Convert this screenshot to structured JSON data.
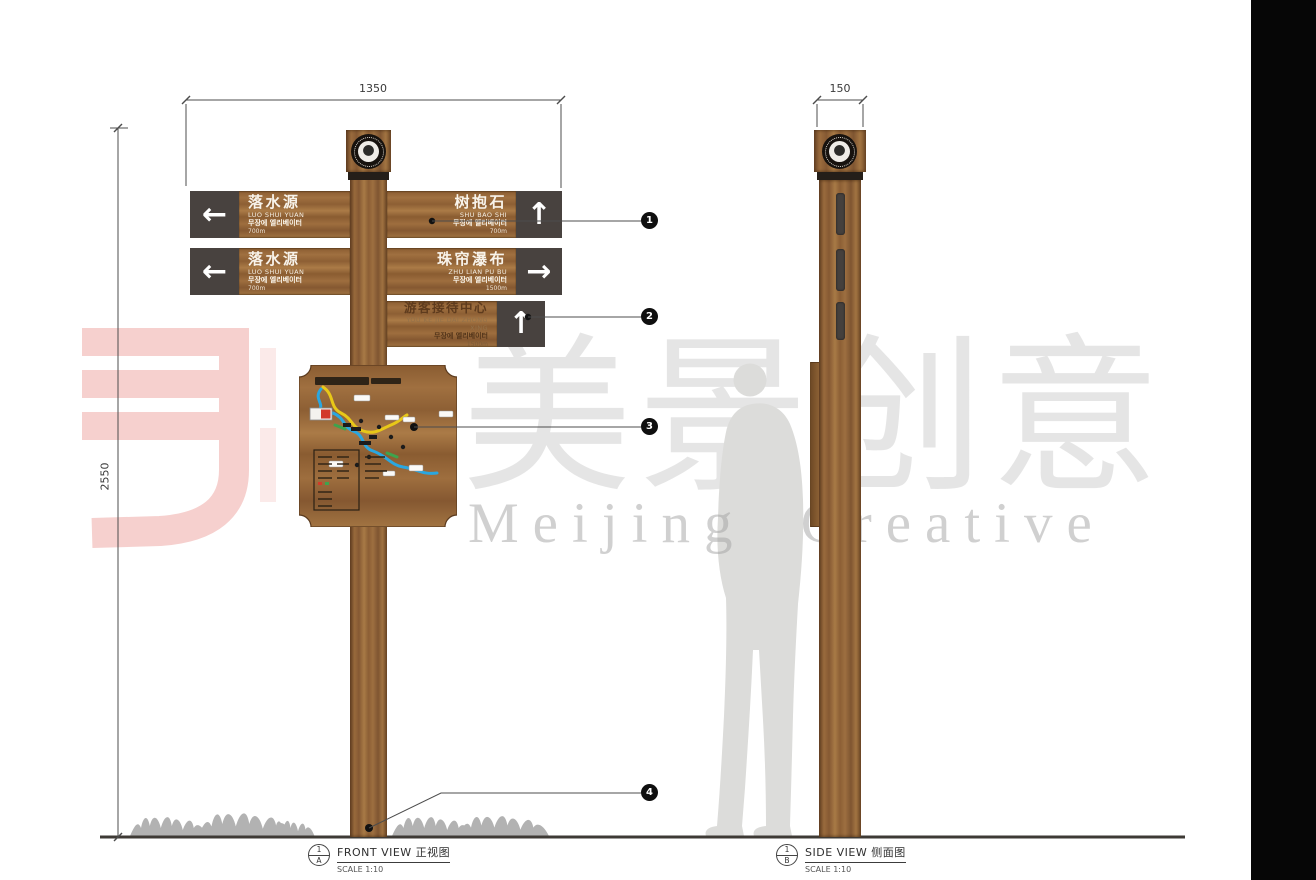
{
  "watermark": {
    "brand_cn": "美景创意",
    "brand_en": "Meijing Creative"
  },
  "dimensions": {
    "front_width": "1350",
    "side_width": "150",
    "height": "2550"
  },
  "callouts": {
    "c1": "1",
    "c2": "2",
    "c3": "3",
    "c4": "4"
  },
  "views": {
    "front": {
      "num": "1",
      "ref": "A",
      "title": "FRONT VIEW 正视图",
      "scale": "SCALE 1:10"
    },
    "side": {
      "num": "1",
      "ref": "B",
      "title": "SIDE VIEW 侧面图",
      "scale": "SCALE 1:10"
    }
  },
  "signs": {
    "row1_left": {
      "title": "落水源",
      "subtitle": "LUO SHUI YUAN",
      "korean": "무장에 엘리베이터",
      "distance": "700m",
      "arrow": "←"
    },
    "row1_right": {
      "title": "树抱石",
      "subtitle": "SHU BAO SHI",
      "korean": "무장에 엘리베이터",
      "distance": "700m",
      "arrow": "↑"
    },
    "row2_left": {
      "title": "落水源",
      "subtitle": "LUO SHUI YUAN",
      "korean": "무장에 엘리베이터",
      "distance": "700m",
      "arrow": "←"
    },
    "row2_right": {
      "title": "珠帘瀑布",
      "subtitle": "ZHU LIAN PU BU",
      "korean": "무장에 엘리베이터",
      "distance": "1500m",
      "arrow": "→"
    },
    "row3_right": {
      "title": "游客接待中心",
      "subtitle": "YOU KE JIE DAI ZHONG XING",
      "korean": "무장에 엘리베이터",
      "distance": "1500m",
      "arrow": "↑"
    }
  }
}
